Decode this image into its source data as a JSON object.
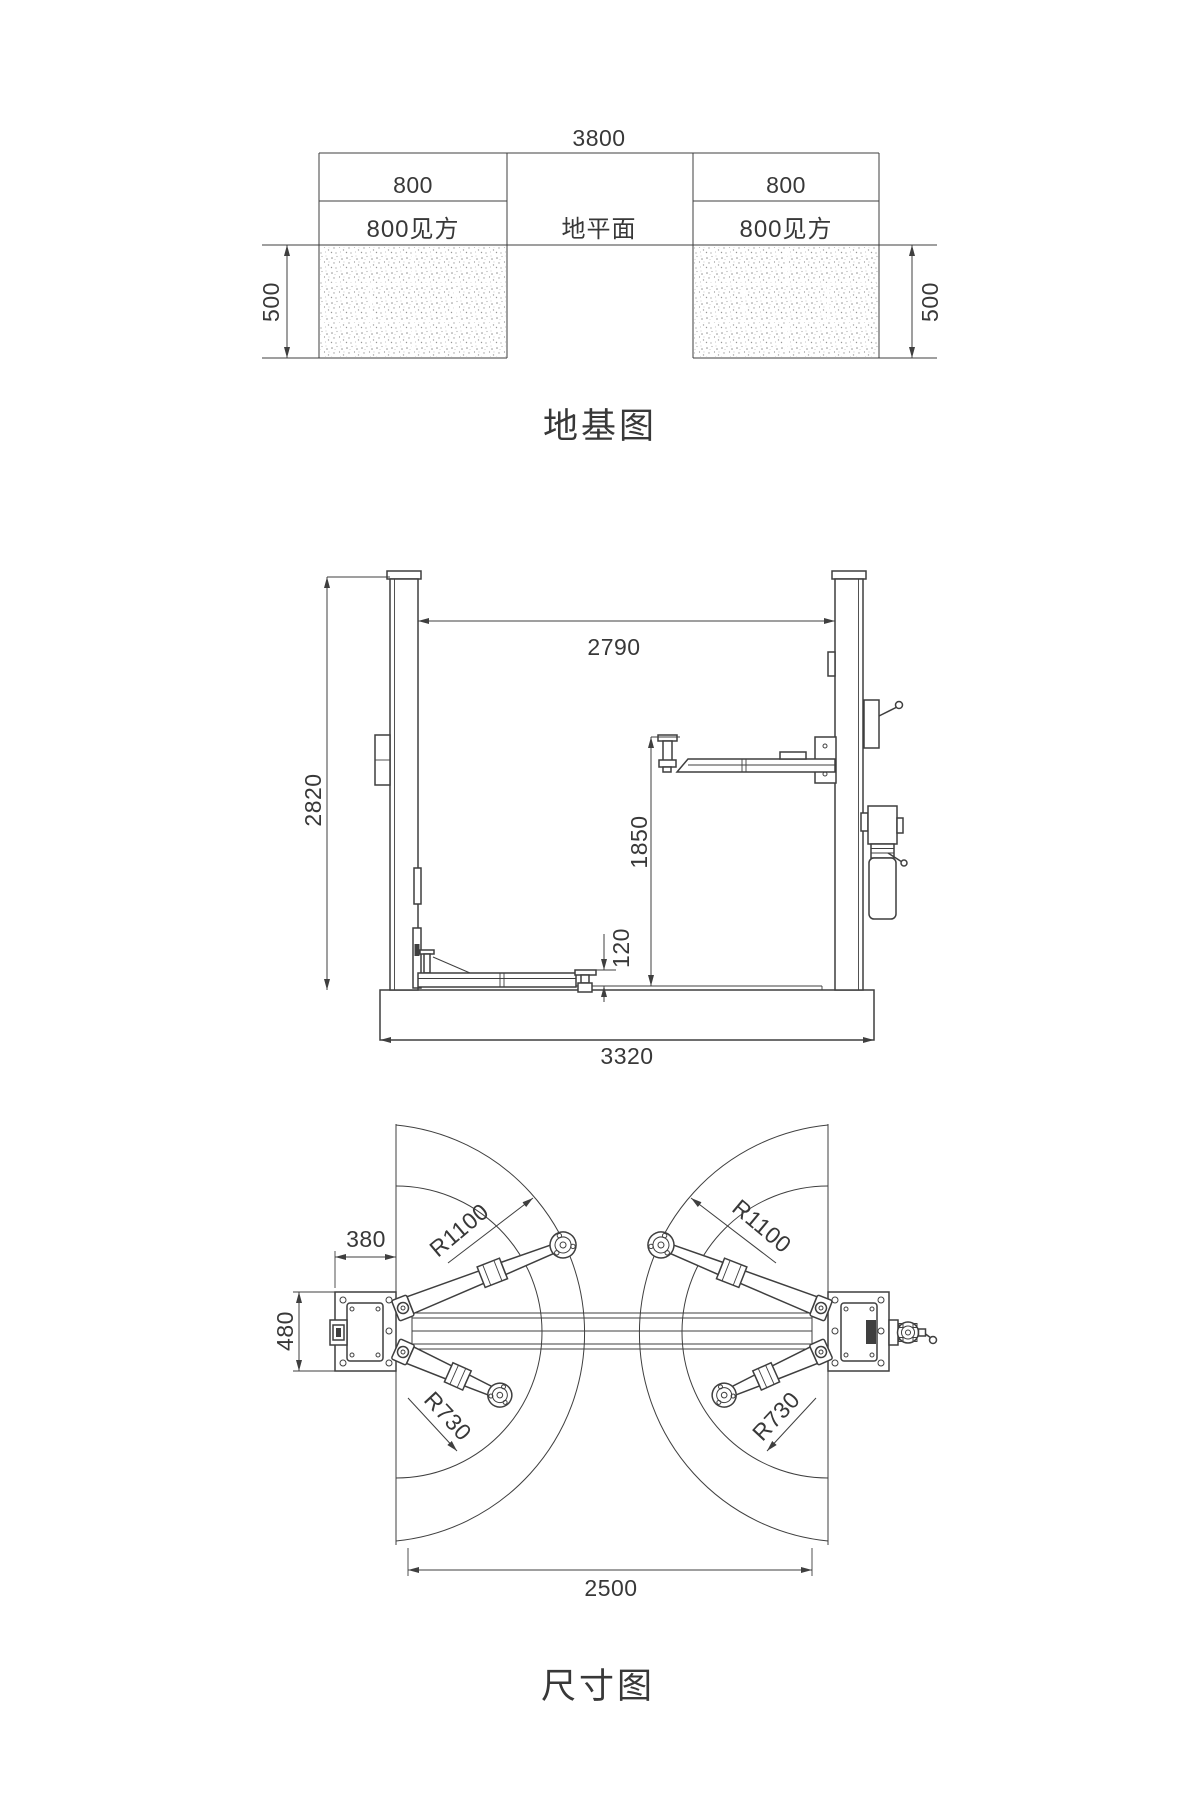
{
  "colors": {
    "line": "#3f3f3f",
    "text": "#383838",
    "speckle": "#9a9a9a"
  },
  "foundation_plan": {
    "title": "地基图",
    "overall_width": "3800",
    "ground_label": "地平面",
    "left_block": {
      "width": "800",
      "label": "800见方",
      "depth": "500"
    },
    "right_block": {
      "width": "800",
      "label": "800见方",
      "depth": "500"
    }
  },
  "front_view": {
    "column_height": "2820",
    "clear_distance": "2790",
    "lift_height": "1850",
    "min_arm_height": "120",
    "overall_width": "3320"
  },
  "plan_view": {
    "title": "尺寸图",
    "base_depth": "380",
    "base_width": "480",
    "swing_radius_front_left": "R1100",
    "swing_radius_front_right": "R1100",
    "swing_radius_rear_left": "R730",
    "swing_radius_rear_right": "R730",
    "post_spacing": "2500"
  }
}
